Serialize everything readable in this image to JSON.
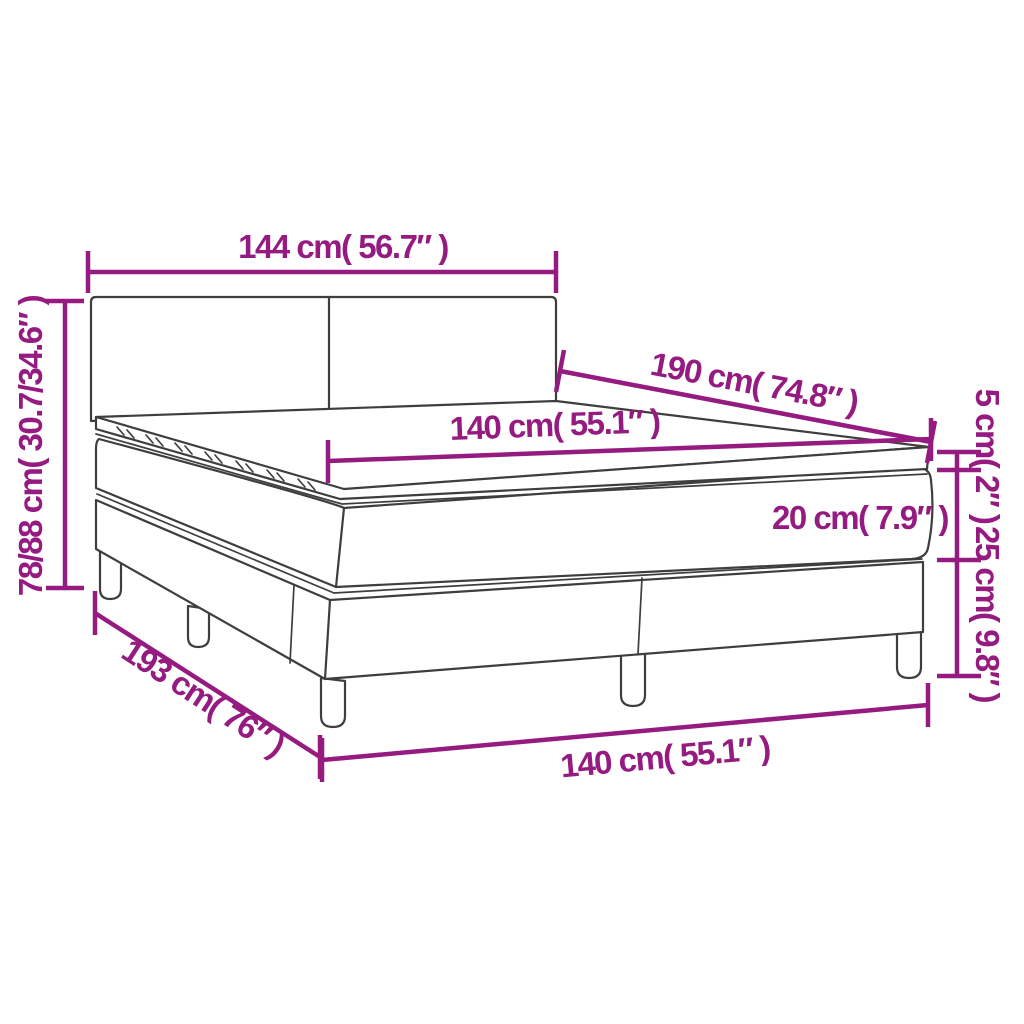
{
  "meta": {
    "description": "Dimension diagram of a box spring bed with headboard, pocket mattress and topper"
  },
  "colors": {
    "dimension_magenta": "#951B81",
    "bed_outline_gray": "#3E3E3D",
    "background": "#FFFFFF"
  },
  "dimensions": {
    "headboard_width": {
      "label": "144 cm( 56.7″ )",
      "cm": "144",
      "inch": "56.7"
    },
    "overall_height": {
      "label": "78/88 cm( 30.7/34.6″ )",
      "cm": "78/88",
      "inch": "30.7/34.6"
    },
    "bed_length": {
      "label": "190 cm( 74.8″ )",
      "cm": "190",
      "inch": "74.8"
    },
    "mattress_width": {
      "label": "140 cm( 55.1″ )",
      "cm": "140",
      "inch": "55.1"
    },
    "topper_height": {
      "label": "5 cm( 2″ )",
      "cm": "5",
      "inch": "2"
    },
    "mattress_height": {
      "label": "20 cm( 7.9″ )",
      "cm": "20",
      "inch": "7.9"
    },
    "base_height": {
      "label": "25 cm( 9.8″ )",
      "cm": "25",
      "inch": "9.8"
    },
    "base_length": {
      "label": "193 cm( 76″ )",
      "cm": "193",
      "inch": "76"
    },
    "base_width": {
      "label": "140 cm( 55.1″ )",
      "cm": "140",
      "inch": "55.1"
    }
  }
}
